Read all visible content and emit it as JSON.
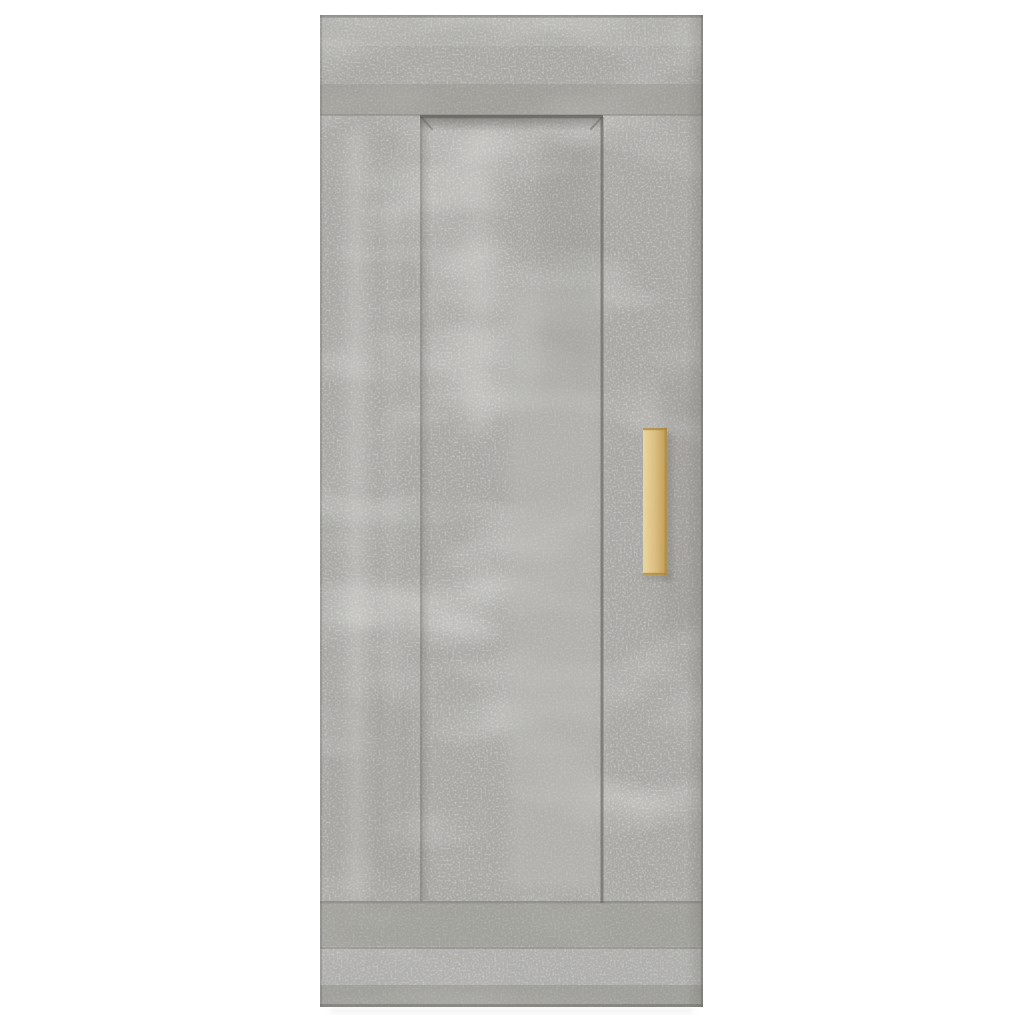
{
  "photo": {
    "alt": "Grey concrete-effect hanging wall cabinet with a light wooden vertical handle, front view on a white background"
  },
  "colors": {
    "background": "#ffffff",
    "concrete_base": "#a9a8a5",
    "band_dark": "#96958f",
    "panel_smooth": "#bab9b6",
    "streak_light": "#d8d7d4",
    "seam_line": "#84837f",
    "recess_shadow": "#5f5e5a",
    "edge_dark": "#6b6a66",
    "handle_light": "#ead79f",
    "handle_mid": "#dcbe80",
    "handle_dark": "#bd9a55",
    "handle_edge": "#a8853f",
    "shadow_soft": "#8c8b87"
  }
}
